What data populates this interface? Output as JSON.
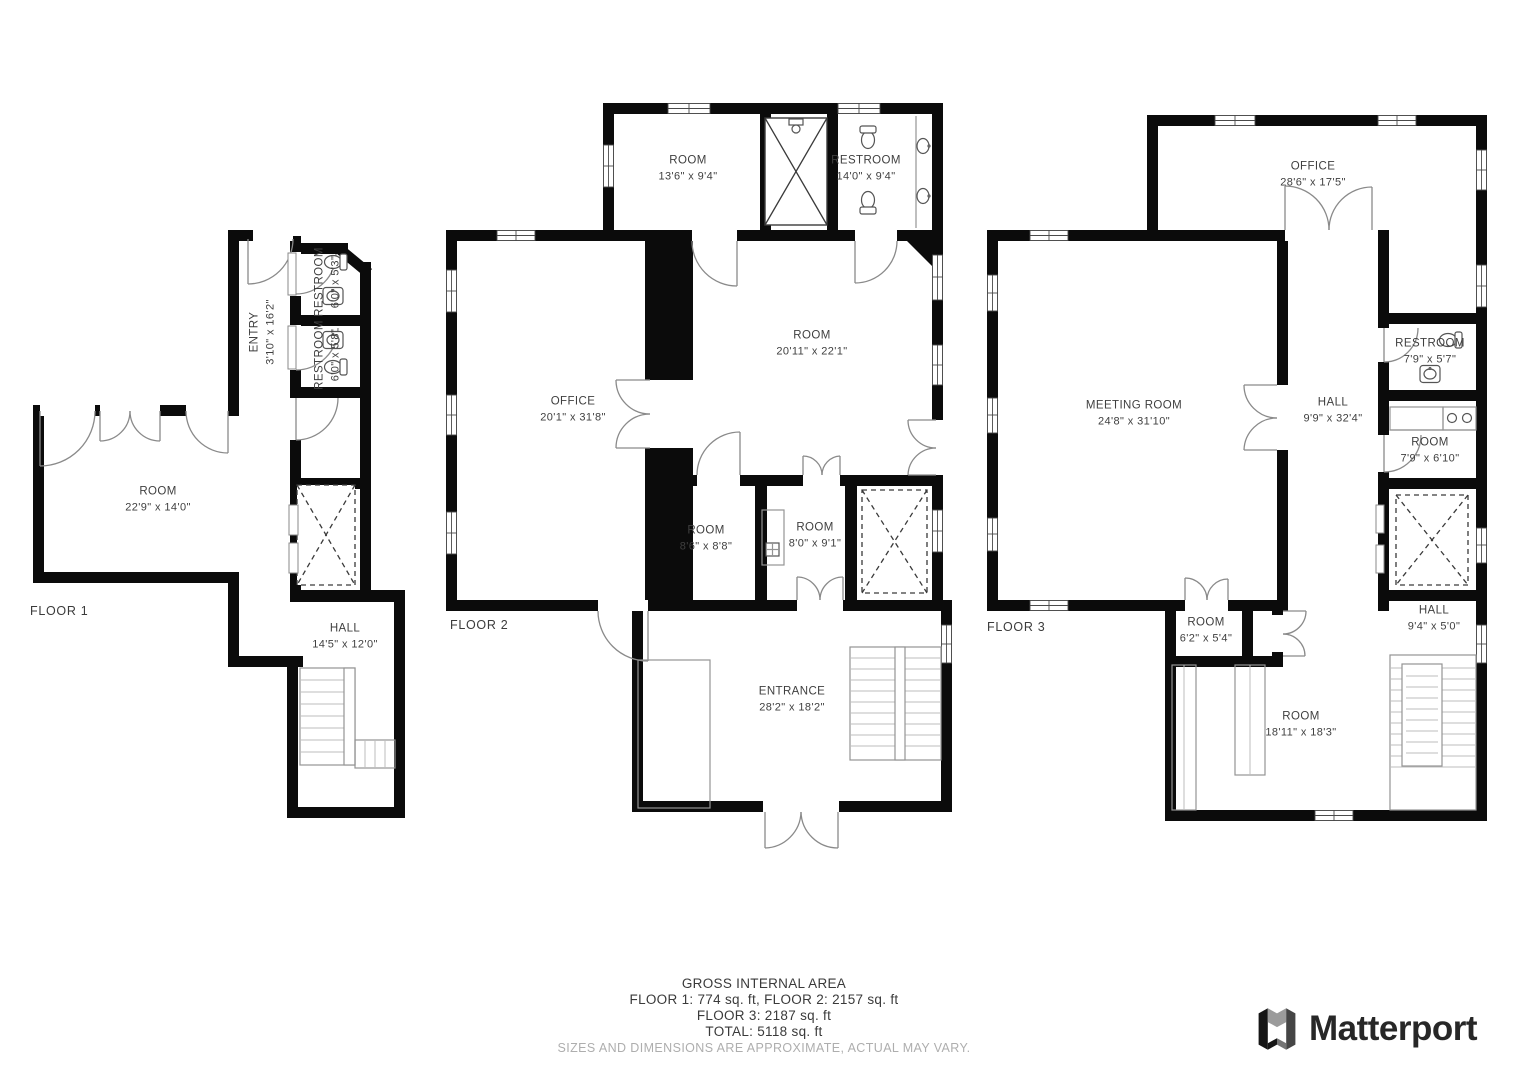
{
  "floors": [
    {
      "label": "FLOOR 1",
      "rooms": [
        {
          "name": "ENTRY",
          "dims": "3'10\" x 16'2\""
        },
        {
          "name": "RESTROOM",
          "dims": "6'0\" x 5'3\""
        },
        {
          "name": "RESTROOM",
          "dims": "6'0\" x 5'8\""
        },
        {
          "name": "ROOM",
          "dims": "22'9\" x 14'0\""
        },
        {
          "name": "HALL",
          "dims": "14'5\" x 12'0\""
        }
      ]
    },
    {
      "label": "FLOOR 2",
      "rooms": [
        {
          "name": "ROOM",
          "dims": "13'6\" x 9'4\""
        },
        {
          "name": "RESTROOM",
          "dims": "14'0\" x 9'4\""
        },
        {
          "name": "OFFICE",
          "dims": "20'1\" x 31'8\""
        },
        {
          "name": "ROOM",
          "dims": "20'11\" x 22'1\""
        },
        {
          "name": "ROOM",
          "dims": "8'6\" x 8'8\""
        },
        {
          "name": "ROOM",
          "dims": "8'0\" x 9'1\""
        },
        {
          "name": "ENTRANCE",
          "dims": "28'2\" x 18'2\""
        }
      ]
    },
    {
      "label": "FLOOR 3",
      "rooms": [
        {
          "name": "OFFICE",
          "dims": "28'6\" x 17'5\""
        },
        {
          "name": "MEETING ROOM",
          "dims": "24'8\" x 31'10\""
        },
        {
          "name": "HALL",
          "dims": "9'9\" x 32'4\""
        },
        {
          "name": "RESTROOM",
          "dims": "7'9\" x 5'7\""
        },
        {
          "name": "ROOM",
          "dims": "7'9\" x 6'10\""
        },
        {
          "name": "ROOM",
          "dims": "6'2\" x 5'4\""
        },
        {
          "name": "HALL",
          "dims": "9'4\" x 5'0\""
        },
        {
          "name": "ROOM",
          "dims": "18'11\" x 18'3\""
        }
      ]
    }
  ],
  "footer": {
    "title": "GROSS INTERNAL AREA",
    "line1": "FLOOR 1: 774 sq. ft, FLOOR 2: 2157 sq. ft",
    "line2": "FLOOR 3: 2187 sq. ft",
    "line3": "TOTAL: 5118 sq. ft",
    "disclaimer": "SIZES AND DIMENSIONS ARE APPROXIMATE, ACTUAL MAY VARY."
  },
  "brand": {
    "name": "Matterport"
  },
  "colors": {
    "wall": "#0b0b0b",
    "label_text": "#3f3f3f",
    "disclaimer_text": "#aeaeae",
    "logo_text": "#272727"
  }
}
